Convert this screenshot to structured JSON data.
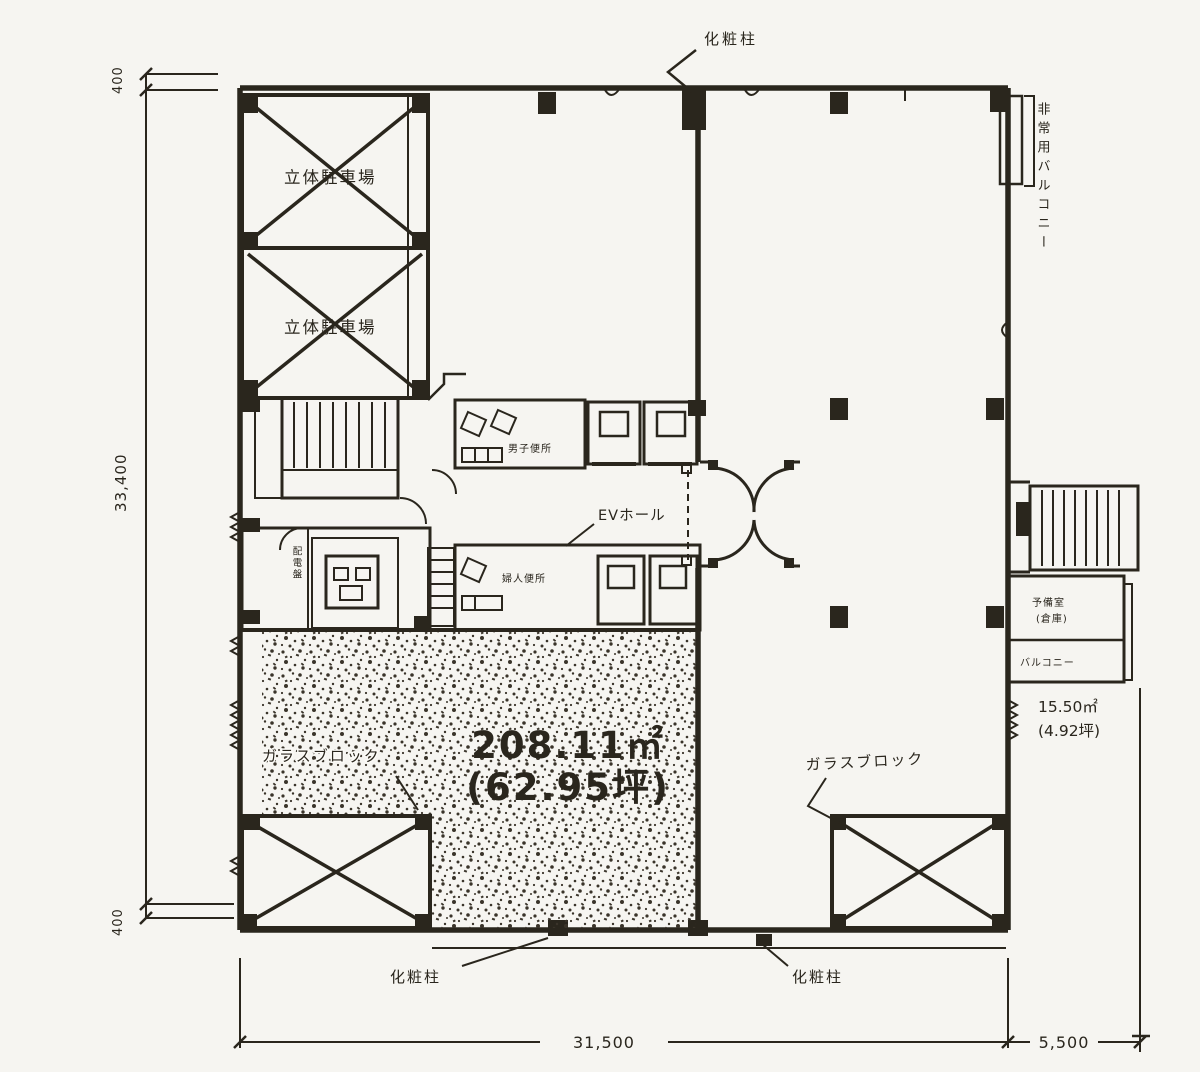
{
  "colors": {
    "paper": "#f6f5f1",
    "ink": "#2e2a22",
    "stipple": "#3d382e"
  },
  "labels": {
    "top_column": "化粧柱",
    "bottom_left_column": "化粧柱",
    "bottom_right_column": "化粧柱",
    "parking_upper": "立体駐車場",
    "parking_lower": "立体駐車場",
    "ev_hall": "EVホール",
    "wc_upper": "男子便所",
    "wc_lower": "婦人便所",
    "panel_room": "配電盤",
    "glass_block_left": "ガラスブロック",
    "glass_block_right": "ガラスブロック",
    "balcony_right_vertical": "非常用バルコニー",
    "annex_room_name": "予備室",
    "annex_room_sub": "(倉庫)",
    "annex_balcony": "バルコニー"
  },
  "areas": {
    "main_sqm": "208.11㎡",
    "main_tsubo": "(62.95坪)",
    "annex_sqm": "15.50㎡",
    "annex_tsubo": "(4.92坪)"
  },
  "dimensions": {
    "left_total": "33,400",
    "left_offset_top": "400",
    "left_offset_bottom": "400",
    "bottom_main": "31,500",
    "bottom_annex": "5,500"
  }
}
